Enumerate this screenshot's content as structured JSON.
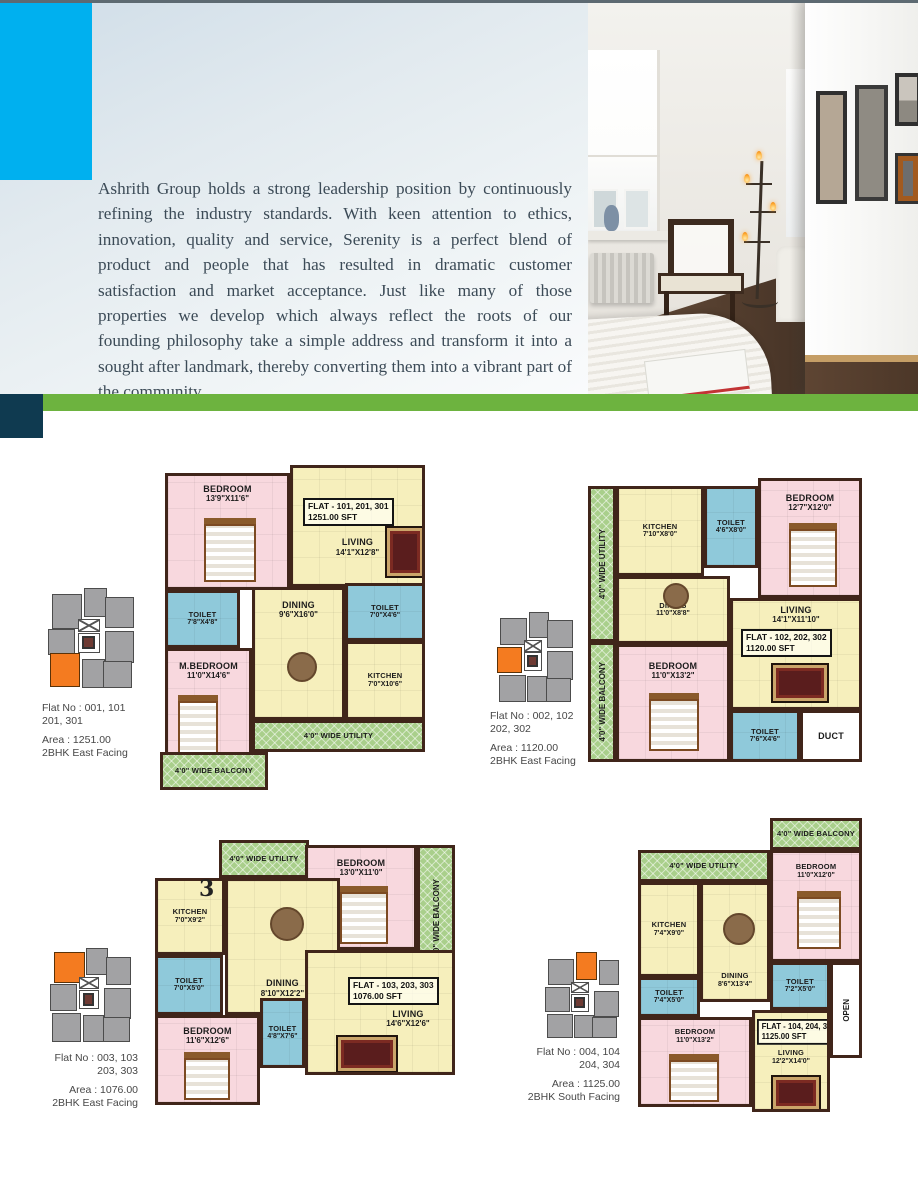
{
  "intro": {
    "paragraph": "Ashrith Group holds a strong leadership position by continuously refining the industry standards. With keen attention to ethics, innovation, quality and service, Serenity is a perfect blend of product and people that has resulted in dramatic customer satisfaction and market acceptance. Just like many of those properties we develop which always reflect the roots of our founding philosophy take a simple address and transform it into a sought after landmark, thereby converting them into a vibrant part of the community."
  },
  "colors": {
    "accent_cyan": "#00b0ef",
    "stripe_green": "#6db33f",
    "navy_block": "#0f3a50",
    "highlight_orange": "#f47b20",
    "room_pink": "#f8d8de",
    "room_yellow": "#f6efbc",
    "room_blue": "#8fc9da",
    "room_green": "#a9cf8b",
    "wall_brown": "#40251a"
  },
  "plans": [
    {
      "flat_box": {
        "line1": "FLAT - 101, 201, 301",
        "line2": "1251.00 SFT"
      },
      "rooms": {
        "bedroom": {
          "name": "BEDROOM",
          "dims": "13'9\"X11'6\""
        },
        "living": {
          "name": "LIVING",
          "dims": "14'1\"X12'8\""
        },
        "toilet_left": {
          "name": "TOILET",
          "dims": "7'8\"X4'8\""
        },
        "toilet_right": {
          "name": "TOILET",
          "dims": "7'0\"X4'6\""
        },
        "dining": {
          "name": "DINING",
          "dims": "9'6\"X16'0\""
        },
        "m_bedroom": {
          "name": "M.BEDROOM",
          "dims": "11'0\"X14'6\""
        },
        "kitchen": {
          "name": "KITCHEN",
          "dims": "7'0\"X10'6\""
        },
        "utility": {
          "label": "4'0\" WIDE UTILITY"
        },
        "balcony": {
          "label": "4'0\" WIDE BALCONY"
        }
      },
      "key_plan": {
        "flat_no_line1": "Flat No : 001, 101",
        "flat_no_line2": "201, 301",
        "area": "Area : 1251.00",
        "facing": "2BHK East Facing"
      }
    },
    {
      "flat_box": {
        "line1": "FLAT - 102, 202, 302",
        "line2": "1120.00 SFT"
      },
      "rooms": {
        "utility": {
          "label": "4'0\" WIDE UTILITY"
        },
        "kitchen": {
          "name": "KITCHEN",
          "dims": "7'10\"X8'0\""
        },
        "toilet_top": {
          "name": "TOILET",
          "dims": "4'6\"X8'0\""
        },
        "bedroom_top": {
          "name": "BEDROOM",
          "dims": "12'7\"X12'0\""
        },
        "dining": {
          "name": "DINING",
          "dims": "11'0\"X8'8\""
        },
        "living": {
          "name": "LIVING",
          "dims": "14'1\"X11'10\""
        },
        "balcony": {
          "label": "4'0\" WIDE BALCONY"
        },
        "bedroom_bottom": {
          "name": "BEDROOM",
          "dims": "11'0\"X13'2\""
        },
        "toilet_bottom": {
          "name": "TOILET",
          "dims": "7'6\"X4'6\""
        },
        "duct": {
          "name": "DUCT"
        }
      },
      "key_plan": {
        "flat_no_line1": "Flat No : 002, 102",
        "flat_no_line2": "202, 302",
        "area": "Area : 1120.00",
        "facing": "2BHK East Facing"
      }
    },
    {
      "flat_box": {
        "line1": "FLAT - 103, 203, 303",
        "line2": "1076.00 SFT"
      },
      "page_number_artifact": "3",
      "rooms": {
        "utility": {
          "label": "4'0\" WIDE UTILITY"
        },
        "bedroom_top": {
          "name": "BEDROOM",
          "dims": "13'0\"X11'0\""
        },
        "balcony": {
          "label": "4'0\" WIDE BALCONY"
        },
        "kitchen": {
          "name": "KITCHEN",
          "dims": "7'0\"X9'2\""
        },
        "dining": {
          "name": "DINING",
          "dims": "8'10\"X12'2\""
        },
        "toilet_left": {
          "name": "TOILET",
          "dims": "7'0\"X5'0\""
        },
        "bedroom_bottom": {
          "name": "BEDROOM",
          "dims": "11'6\"X12'6\""
        },
        "toilet_mid": {
          "name": "TOILET",
          "dims": "4'8\"X7'6\""
        },
        "living": {
          "name": "LIVING",
          "dims": "14'6\"X12'6\""
        }
      },
      "key_plan": {
        "flat_no_line1": "Flat No : 003, 103",
        "flat_no_line2": "203, 303",
        "area": "Area : 1076.00",
        "facing": "2BHK East Facing"
      }
    },
    {
      "flat_box": {
        "line1": "FLAT - 104, 204, 304",
        "line2": "1125.00 SFT"
      },
      "rooms": {
        "balcony": {
          "label": "4'0\" WIDE BALCONY"
        },
        "utility": {
          "label": "4'0\" WIDE UTILITY"
        },
        "bedroom_top": {
          "name": "BEDROOM",
          "dims": "11'0\"X12'0\""
        },
        "kitchen": {
          "name": "KITCHEN",
          "dims": "7'4\"X9'0\""
        },
        "dining": {
          "name": "DINING",
          "dims": "8'6\"X13'4\""
        },
        "toilet_left": {
          "name": "TOILET",
          "dims": "7'4\"X5'0\""
        },
        "toilet_right": {
          "name": "TOILET",
          "dims": "7'2\"X5'0\""
        },
        "open": {
          "name": "OPEN"
        },
        "bedroom_bottom": {
          "name": "BEDROOM",
          "dims": "11'0\"X13'2\""
        },
        "living": {
          "name": "LIVING",
          "dims": "12'2\"X14'0\""
        }
      },
      "key_plan": {
        "flat_no_line1": "Flat No : 004, 104",
        "flat_no_line2": "204, 304",
        "area": "Area : 1125.00",
        "facing": "2BHK South Facing"
      }
    }
  ]
}
